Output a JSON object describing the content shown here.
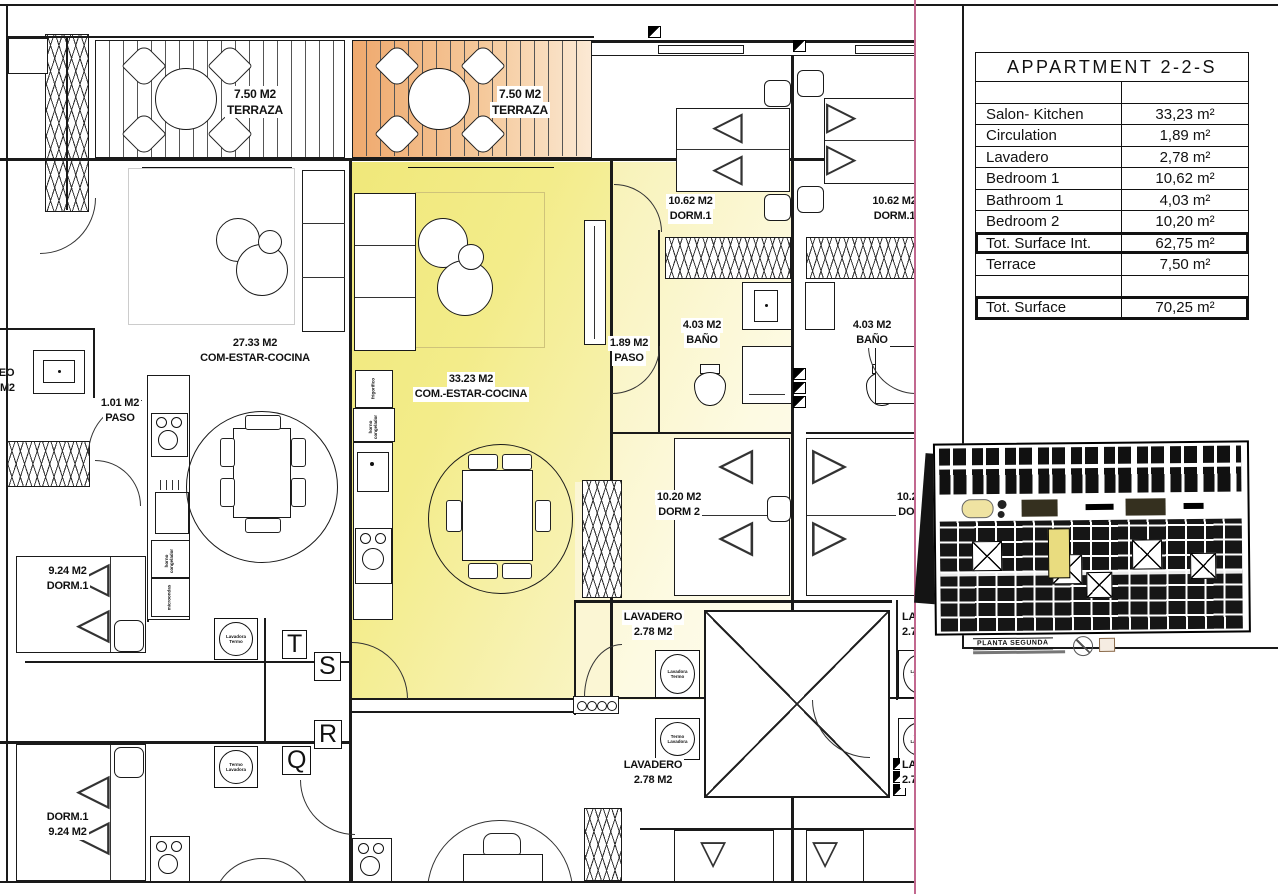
{
  "sheet": {
    "table": {
      "title": "APPARTMENT 2-2-S",
      "rows": [
        {
          "label": "",
          "value": ""
        },
        {
          "label": "Salon- Kitchen",
          "value": "33,23 m²"
        },
        {
          "label": "Circulation",
          "value": "1,89 m²"
        },
        {
          "label": "Lavadero",
          "value": "2,78 m²"
        },
        {
          "label": "Bedroom 1",
          "value": "10,62 m²"
        },
        {
          "label": "Bathroom 1",
          "value": "4,03 m²"
        },
        {
          "label": "Bedroom 2",
          "value": "10,20 m²"
        },
        {
          "label": "Tot. Surface Int.",
          "value": "62,75 m²"
        },
        {
          "label": "Terrace",
          "value": "7,50 m²"
        },
        {
          "label": "",
          "value": ""
        },
        {
          "label": "Tot. Surface",
          "value": "70,25 m²"
        }
      ]
    },
    "overview": {
      "caption": "PLANTA SEGUNDA"
    }
  },
  "plan": {
    "labels": {
      "terraza_left": {
        "area": "7.50 M2",
        "name": "TERRAZA"
      },
      "terraza_right": {
        "area": "7.50 M2",
        "name": "TERRAZA"
      },
      "salon_left": {
        "area": "27.33 M2",
        "name": "COM-ESTAR-COCINA"
      },
      "salon_center": {
        "area": "33.23 M2",
        "name": "COM.-ESTAR-COCINA"
      },
      "paso_left": {
        "area": "1.01 M2",
        "name": "PASO"
      },
      "paso_center": {
        "area": "1.89 M2",
        "name": "PASO"
      },
      "aseo_cut": {
        "area": "1 M2",
        "name": "SEO"
      },
      "dorm1_left_upper": {
        "area": "9.24 M2",
        "name": "DORM.1"
      },
      "dorm1_left_lower": {
        "area": "DORM.1",
        "name": "9.24 M2"
      },
      "dorm1_center": {
        "area": "10.62 M2",
        "name": "DORM.1"
      },
      "dorm1_right": {
        "area": "10.62 M2",
        "name": "DORM.1"
      },
      "bano_center": {
        "area": "4.03 M2",
        "name": "BAÑO"
      },
      "bano_right": {
        "area": "4.03 M2",
        "name": "BAÑO"
      },
      "dorm2_center": {
        "area": "10.20 M2",
        "name": "DORM 2"
      },
      "dorm2_right": {
        "area": "10.20 M2",
        "name": "DORM 2"
      },
      "lavadero_center_upper": {
        "area": "LAVADERO",
        "name": "2.78 M2"
      },
      "lavadero_center_lower": {
        "area": "LAVADERO",
        "name": "2.78 M2"
      },
      "lavadero_right_upper": {
        "area": "LAVADERO",
        "name": "2.78 M2"
      },
      "lavadero_right_lower": {
        "area": "LAVADERO",
        "name": "2.78 M2"
      }
    },
    "units": {
      "t": "T",
      "s": "S",
      "r": "R",
      "q": "Q"
    },
    "appliances": {
      "washer_upper": "Lavadora Termo",
      "washer_lower": "Termo Lavadora",
      "oven": "horno congelador",
      "microwave": "microondas",
      "fridge": "frigorifico"
    },
    "colors": {
      "highlight_yellow": "#f2eb7d",
      "terrace_orange": "#efa96e",
      "sheet_line_magenta": "#c2688f"
    }
  }
}
